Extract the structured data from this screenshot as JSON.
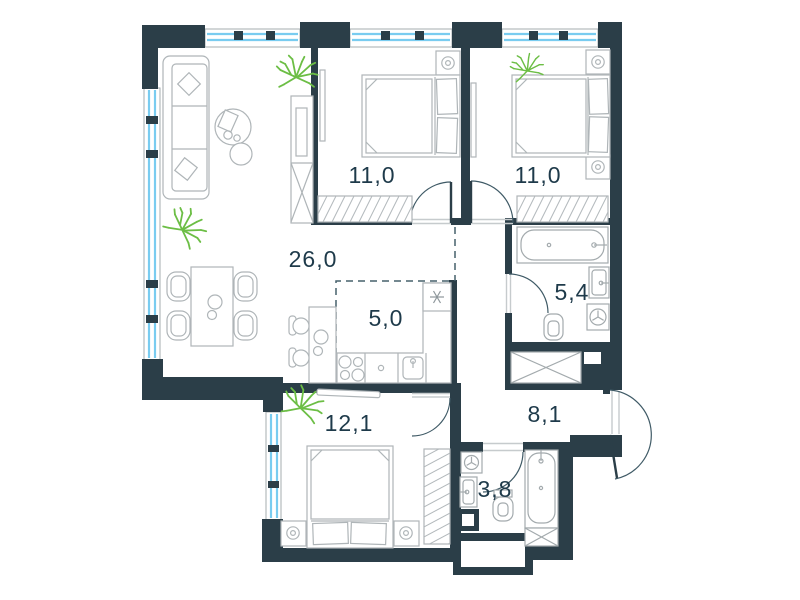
{
  "plan": {
    "type": "apartment-floor-plan",
    "rooms": [
      {
        "id": "living-dining",
        "area": "26,0"
      },
      {
        "id": "bedroom-1",
        "area": "11,0"
      },
      {
        "id": "bedroom-2",
        "area": "11,0"
      },
      {
        "id": "kitchen",
        "area": "5,0"
      },
      {
        "id": "bathroom-main",
        "area": "5,4"
      },
      {
        "id": "hallway",
        "area": "8,1"
      },
      {
        "id": "bedroom-3",
        "area": "12,1"
      },
      {
        "id": "bathroom-small",
        "area": "3,8"
      }
    ],
    "colors": {
      "walls": "#2B3E48",
      "furniture_outline": "#AFB5B8",
      "window_glass": "#79CCF0",
      "plant": "#6CBE45",
      "label_text": "#1E3A4A",
      "background": "#FFFFFF"
    }
  }
}
